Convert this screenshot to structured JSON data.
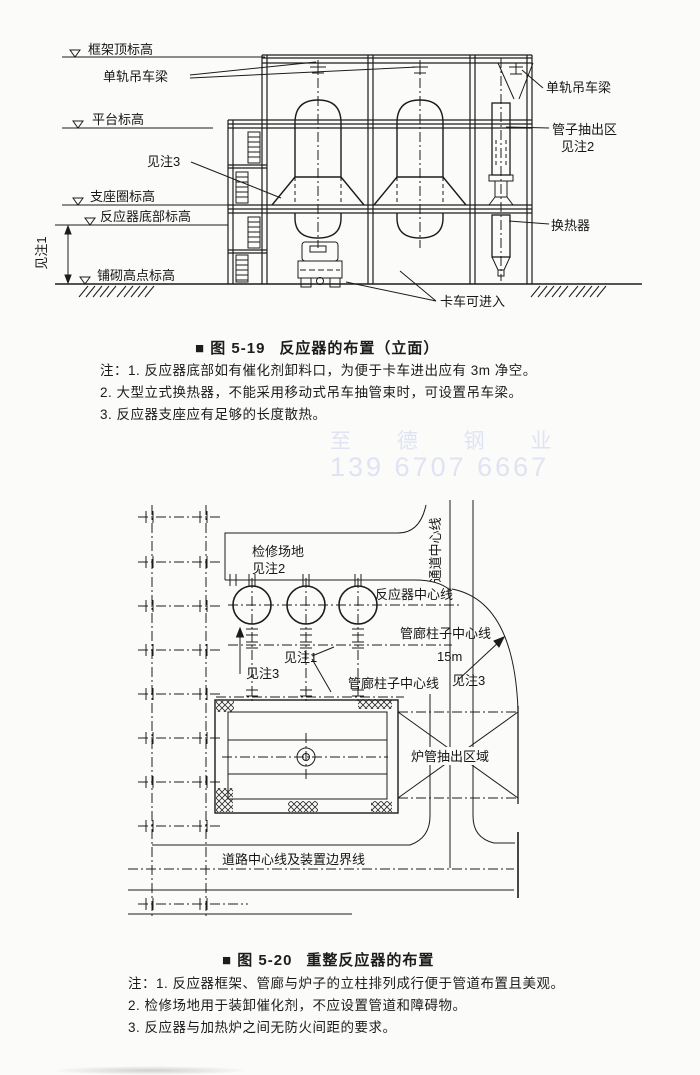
{
  "page": {
    "background": "#fbfbf9",
    "ink": "#1c1c1c"
  },
  "watermark": {
    "line1": "至 德 钢 业",
    "line2": "139 6707 6667",
    "color": "#dfe3f4"
  },
  "figure1": {
    "caption_tag": "■ 图 5-19",
    "caption_title": "反应器的布置（立面）",
    "notes": [
      "注：1. 反应器底部如有催化剂卸料口，为便于卡车进出应有 3m 净空。",
      "2. 大型立式换热器，不能采用移动式吊车抽管束时，可设置吊车梁。",
      "3. 反应器支座应有足够的长度散热。"
    ],
    "labels": {
      "frame_top": "框架顶标高",
      "monorail_left": "单轨吊车梁",
      "platform": "平台标高",
      "see_note3": "见注3",
      "support_ring": "支座圈标高",
      "reactor_bottom": "反应器底部标高",
      "see_note1": "见注1",
      "paving_high": "铺砌高点标高",
      "monorail_right": "单轨吊车梁",
      "tube_pull": "管子抽出区",
      "tube_pull_note": "见注2",
      "heat_exchanger": "换热器",
      "truck_access": "卡车可进入"
    }
  },
  "figure2": {
    "caption_tag": "■ 图 5-20",
    "caption_title": "重整反应器的布置",
    "notes": [
      "注：1. 反应器框架、管廊与炉子的立柱排列成行便于管道布置且美观。",
      "2. 检修场地用于装卸催化剂，不应设置管道和障碍物。",
      "3. 反应器与加热炉之间无防火间距的要求。"
    ],
    "labels": {
      "maintenance_area": "检修场地",
      "maintenance_note": "见注2",
      "passage_cl": "通道中心线",
      "reactor_cl": "反应器中心线",
      "pipe_rack_cl_upper": "管廊柱子中心线",
      "dim_15m": "15m",
      "see_note3_right": "见注3",
      "pipe_rack_cl_lower": "管廊柱子中心线",
      "see_note1": "见注1",
      "see_note3_left": "见注3",
      "furnace_tube_area": "炉管抽出区域",
      "road_cl": "道路中心线及装置边界线"
    }
  }
}
